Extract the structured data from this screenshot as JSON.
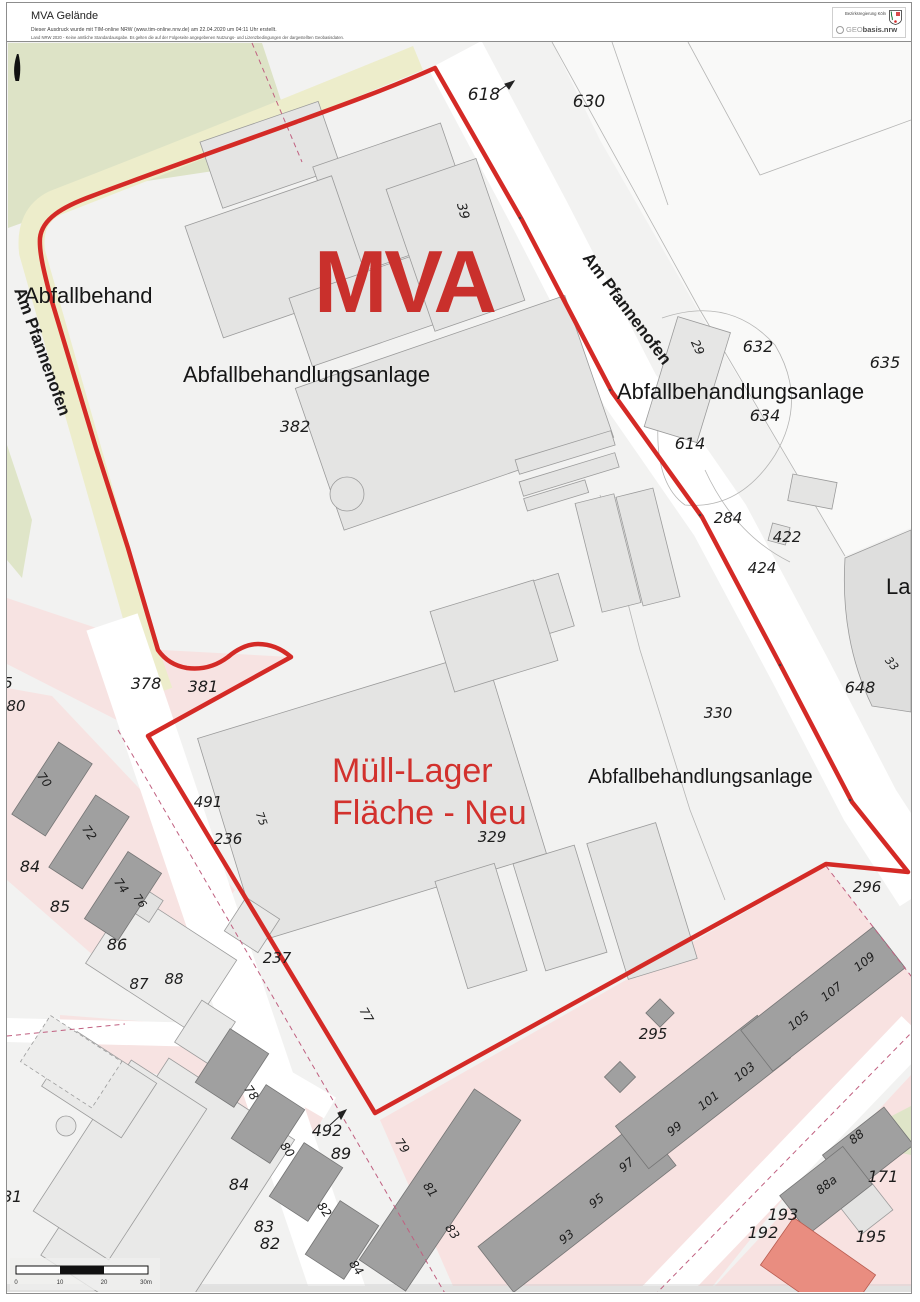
{
  "header": {
    "title": "MVA Gelände",
    "disclaimer_line1": "Dieser Ausdruck wurde mit TIM-online NRW (www.tim-online.nrw.de) am 22.04.2020 um 04:11 Uhr erstellt.",
    "disclaimer_line2": "Land NRW 2020 - Keine amtliche Standardausgabe. Es gelten die auf der Folgeseite angegebenen Nutzungs- und Lizenzbedingungen der dargestellten Geobasisdaten.",
    "agency": "Bezirksregierung Köln",
    "geobasis_logo_prefix": "GEO",
    "geobasis_logo_suffix": "basis.nrw"
  },
  "map": {
    "big_label": "MVA",
    "site_label": {
      "line1": "Müll-Lager",
      "line2": "Fläche - Neu"
    },
    "street_left": "Am Pfannenofen",
    "street_right": "Am Pfannenofen",
    "area_labels": [
      {
        "t": "Abfallbehandlungsanlage",
        "x": 183,
        "y": 382,
        "s": 22
      },
      {
        "t": "Abfallbehand",
        "x": 24,
        "y": 303,
        "s": 22
      },
      {
        "t": "Abfallbehandlungsanlage",
        "x": 617,
        "y": 399,
        "s": 22
      },
      {
        "t": "Abfallbehandlungsanlage",
        "x": 588,
        "y": 783,
        "s": 20
      },
      {
        "t": "La",
        "x": 886,
        "y": 594,
        "s": 22
      }
    ],
    "parcel_labels": [
      {
        "t": "618",
        "x": 484,
        "y": 100,
        "s": 17
      },
      {
        "t": "630",
        "x": 589,
        "y": 107,
        "s": 17
      },
      {
        "t": "39",
        "x": 459,
        "y": 212,
        "s": 13,
        "r": 75
      },
      {
        "t": "382",
        "x": 295,
        "y": 432,
        "s": 16
      },
      {
        "t": "632",
        "x": 758,
        "y": 352,
        "s": 16
      },
      {
        "t": "634",
        "x": 765,
        "y": 421,
        "s": 16
      },
      {
        "t": "635",
        "x": 885,
        "y": 368,
        "s": 16
      },
      {
        "t": "614",
        "x": 690,
        "y": 449,
        "s": 16
      },
      {
        "t": "29",
        "x": 694,
        "y": 349,
        "s": 12,
        "r": 65
      },
      {
        "t": "284",
        "x": 728,
        "y": 523,
        "s": 15
      },
      {
        "t": "422",
        "x": 787,
        "y": 542,
        "s": 15
      },
      {
        "t": "424",
        "x": 762,
        "y": 573,
        "s": 15
      },
      {
        "t": "648",
        "x": 860,
        "y": 693,
        "s": 16
      },
      {
        "t": "33",
        "x": 889,
        "y": 666,
        "s": 11,
        "r": 50
      },
      {
        "t": "330",
        "x": 718,
        "y": 718,
        "s": 15
      },
      {
        "t": "378",
        "x": 146,
        "y": 689,
        "s": 16
      },
      {
        "t": "381",
        "x": 203,
        "y": 692,
        "s": 16
      },
      {
        "t": "491",
        "x": 208,
        "y": 807,
        "s": 15
      },
      {
        "t": "75",
        "x": 258,
        "y": 820,
        "s": 11,
        "r": 70
      },
      {
        "t": "236",
        "x": 228,
        "y": 844,
        "s": 15
      },
      {
        "t": "329",
        "x": 492,
        "y": 842,
        "s": 15
      },
      {
        "t": "296",
        "x": 867,
        "y": 892,
        "s": 15
      },
      {
        "t": "295",
        "x": 653,
        "y": 1039,
        "s": 15
      },
      {
        "t": "492",
        "x": 327,
        "y": 1136,
        "s": 16
      },
      {
        "t": "89",
        "x": 341,
        "y": 1159,
        "s": 16
      },
      {
        "t": "237",
        "x": 277,
        "y": 963,
        "s": 15
      },
      {
        "t": "77",
        "x": 363,
        "y": 1017,
        "s": 12,
        "r": 60
      },
      {
        "t": "5",
        "x": 8,
        "y": 688,
        "s": 15
      },
      {
        "t": "80",
        "x": 16,
        "y": 711,
        "s": 15
      },
      {
        "t": "84",
        "x": 30,
        "y": 872,
        "s": 16
      },
      {
        "t": "70",
        "x": 41,
        "y": 782,
        "s": 12,
        "r": 55
      },
      {
        "t": "72",
        "x": 86,
        "y": 835,
        "s": 12,
        "r": 55
      },
      {
        "t": "74",
        "x": 118,
        "y": 888,
        "s": 12,
        "r": 55
      },
      {
        "t": "85",
        "x": 60,
        "y": 912,
        "s": 16
      },
      {
        "t": "76",
        "x": 137,
        "y": 903,
        "s": 11,
        "r": 55
      },
      {
        "t": "86",
        "x": 117,
        "y": 950,
        "s": 16
      },
      {
        "t": "87",
        "x": 139,
        "y": 989,
        "s": 15
      },
      {
        "t": "88",
        "x": 174,
        "y": 984,
        "s": 15
      },
      {
        "t": "81",
        "x": 12,
        "y": 1202,
        "s": 16
      },
      {
        "t": "78",
        "x": 248,
        "y": 1095,
        "s": 12,
        "r": 55
      },
      {
        "t": "80",
        "x": 284,
        "y": 1152,
        "s": 12,
        "r": 55
      },
      {
        "t": "82",
        "x": 321,
        "y": 1212,
        "s": 12,
        "r": 55
      },
      {
        "t": "84",
        "x": 353,
        "y": 1270,
        "s": 12,
        "r": 55
      },
      {
        "t": "84",
        "x": 239,
        "y": 1190,
        "s": 16
      },
      {
        "t": "83",
        "x": 264,
        "y": 1232,
        "s": 16
      },
      {
        "t": "82",
        "x": 270,
        "y": 1249,
        "s": 16
      },
      {
        "t": "79",
        "x": 399,
        "y": 1148,
        "s": 12,
        "r": 55
      },
      {
        "t": "81",
        "x": 427,
        "y": 1192,
        "s": 12,
        "r": 55
      },
      {
        "t": "83",
        "x": 449,
        "y": 1234,
        "s": 12,
        "r": 55
      },
      {
        "t": "93",
        "x": 569,
        "y": 1240,
        "s": 12,
        "r": -38
      },
      {
        "t": "95",
        "x": 599,
        "y": 1204,
        "s": 12,
        "r": -38
      },
      {
        "t": "97",
        "x": 629,
        "y": 1168,
        "s": 12,
        "r": -38
      },
      {
        "t": "99",
        "x": 677,
        "y": 1132,
        "s": 12,
        "r": -38
      },
      {
        "t": "101",
        "x": 711,
        "y": 1104,
        "s": 12,
        "r": -38
      },
      {
        "t": "103",
        "x": 747,
        "y": 1075,
        "s": 12,
        "r": -38
      },
      {
        "t": "105",
        "x": 801,
        "y": 1024,
        "s": 12,
        "r": -38
      },
      {
        "t": "107",
        "x": 834,
        "y": 995,
        "s": 12,
        "r": -38
      },
      {
        "t": "109",
        "x": 867,
        "y": 965,
        "s": 12,
        "r": -38
      },
      {
        "t": "88",
        "x": 859,
        "y": 1140,
        "s": 12,
        "r": -38
      },
      {
        "t": "88a",
        "x": 829,
        "y": 1188,
        "s": 12,
        "r": -38
      },
      {
        "t": "171",
        "x": 883,
        "y": 1182,
        "s": 16
      },
      {
        "t": "193",
        "x": 783,
        "y": 1220,
        "s": 16
      },
      {
        "t": "192",
        "x": 763,
        "y": 1238,
        "s": 16
      },
      {
        "t": "195",
        "x": 871,
        "y": 1242,
        "s": 16
      }
    ],
    "scale_bar": {
      "ticks": [
        "0",
        "10",
        "20",
        "30m"
      ]
    },
    "colors": {
      "boundary_red": "#d42a26",
      "annotation_red": "#d2312d",
      "residential_pink": "#f7e3e2",
      "street_khaki": "#ededcb",
      "green_area": "#dde3c6",
      "building_gray": "#e4e4e3",
      "house_dark_gray": "#a0a0a0",
      "salmon_building": "#e98d80"
    }
  }
}
